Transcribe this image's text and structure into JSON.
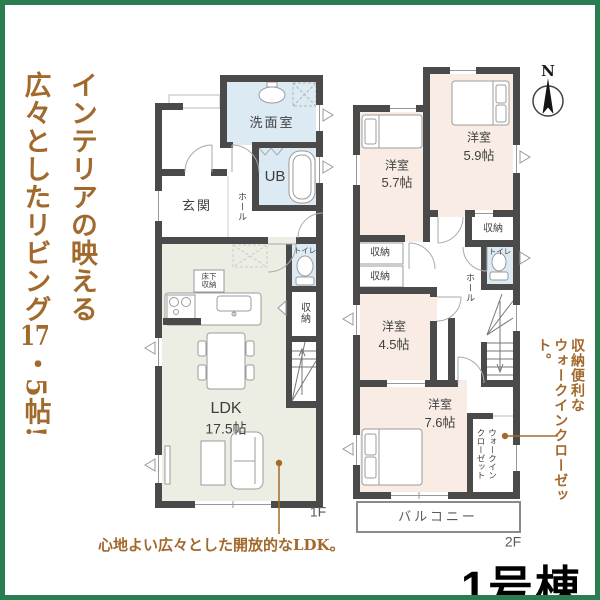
{
  "headline": {
    "line1": "インテリアの映える",
    "line2_pre": "広々としたリビング",
    "line2_tcy": "17",
    "line2_post": "・5帖!"
  },
  "captions": {
    "ldk_note": "心地よい広々とした開放的なLDK。",
    "wic_note_line1": "収納便利な",
    "wic_note_line2": "ウォークインクローゼット。"
  },
  "building": {
    "label": "1号棟"
  },
  "compass": {
    "north": "N"
  },
  "floor1": {
    "floor_label": "1F",
    "washroom": "洗面室",
    "bath": "UB",
    "entrance": "玄関",
    "hall": "ホール",
    "toilet": "トイレ",
    "closet": "収納",
    "underfloor_storage_line1": "床下",
    "underfloor_storage_line2": "収納",
    "ldk_name": "LDK",
    "ldk_size": "17.5帖"
  },
  "floor2": {
    "floor_label": "2F",
    "bedroom1_name": "洋室",
    "bedroom1_size": "5.7帖",
    "bedroom2_name": "洋室",
    "bedroom2_size": "5.9帖",
    "bedroom3_name": "洋室",
    "bedroom3_size": "4.5帖",
    "bedroom4_name": "洋室",
    "bedroom4_size": "7.6帖",
    "closet_a": "収納",
    "closet_b": "収納",
    "closet_c": "収納",
    "toilet": "トイレ",
    "hall": "ホール",
    "wic_line1": "ウォークイン",
    "wic_line2": "クローゼット",
    "balcony": "バルコニー"
  },
  "colors": {
    "wall": "#4a4a4a",
    "wet_room": "#dbeaf3",
    "ldk": "#ecede3",
    "bedroom": "#f9ece4",
    "accent_brown": "#a2692c",
    "frame_green": "#2a7d4e"
  }
}
